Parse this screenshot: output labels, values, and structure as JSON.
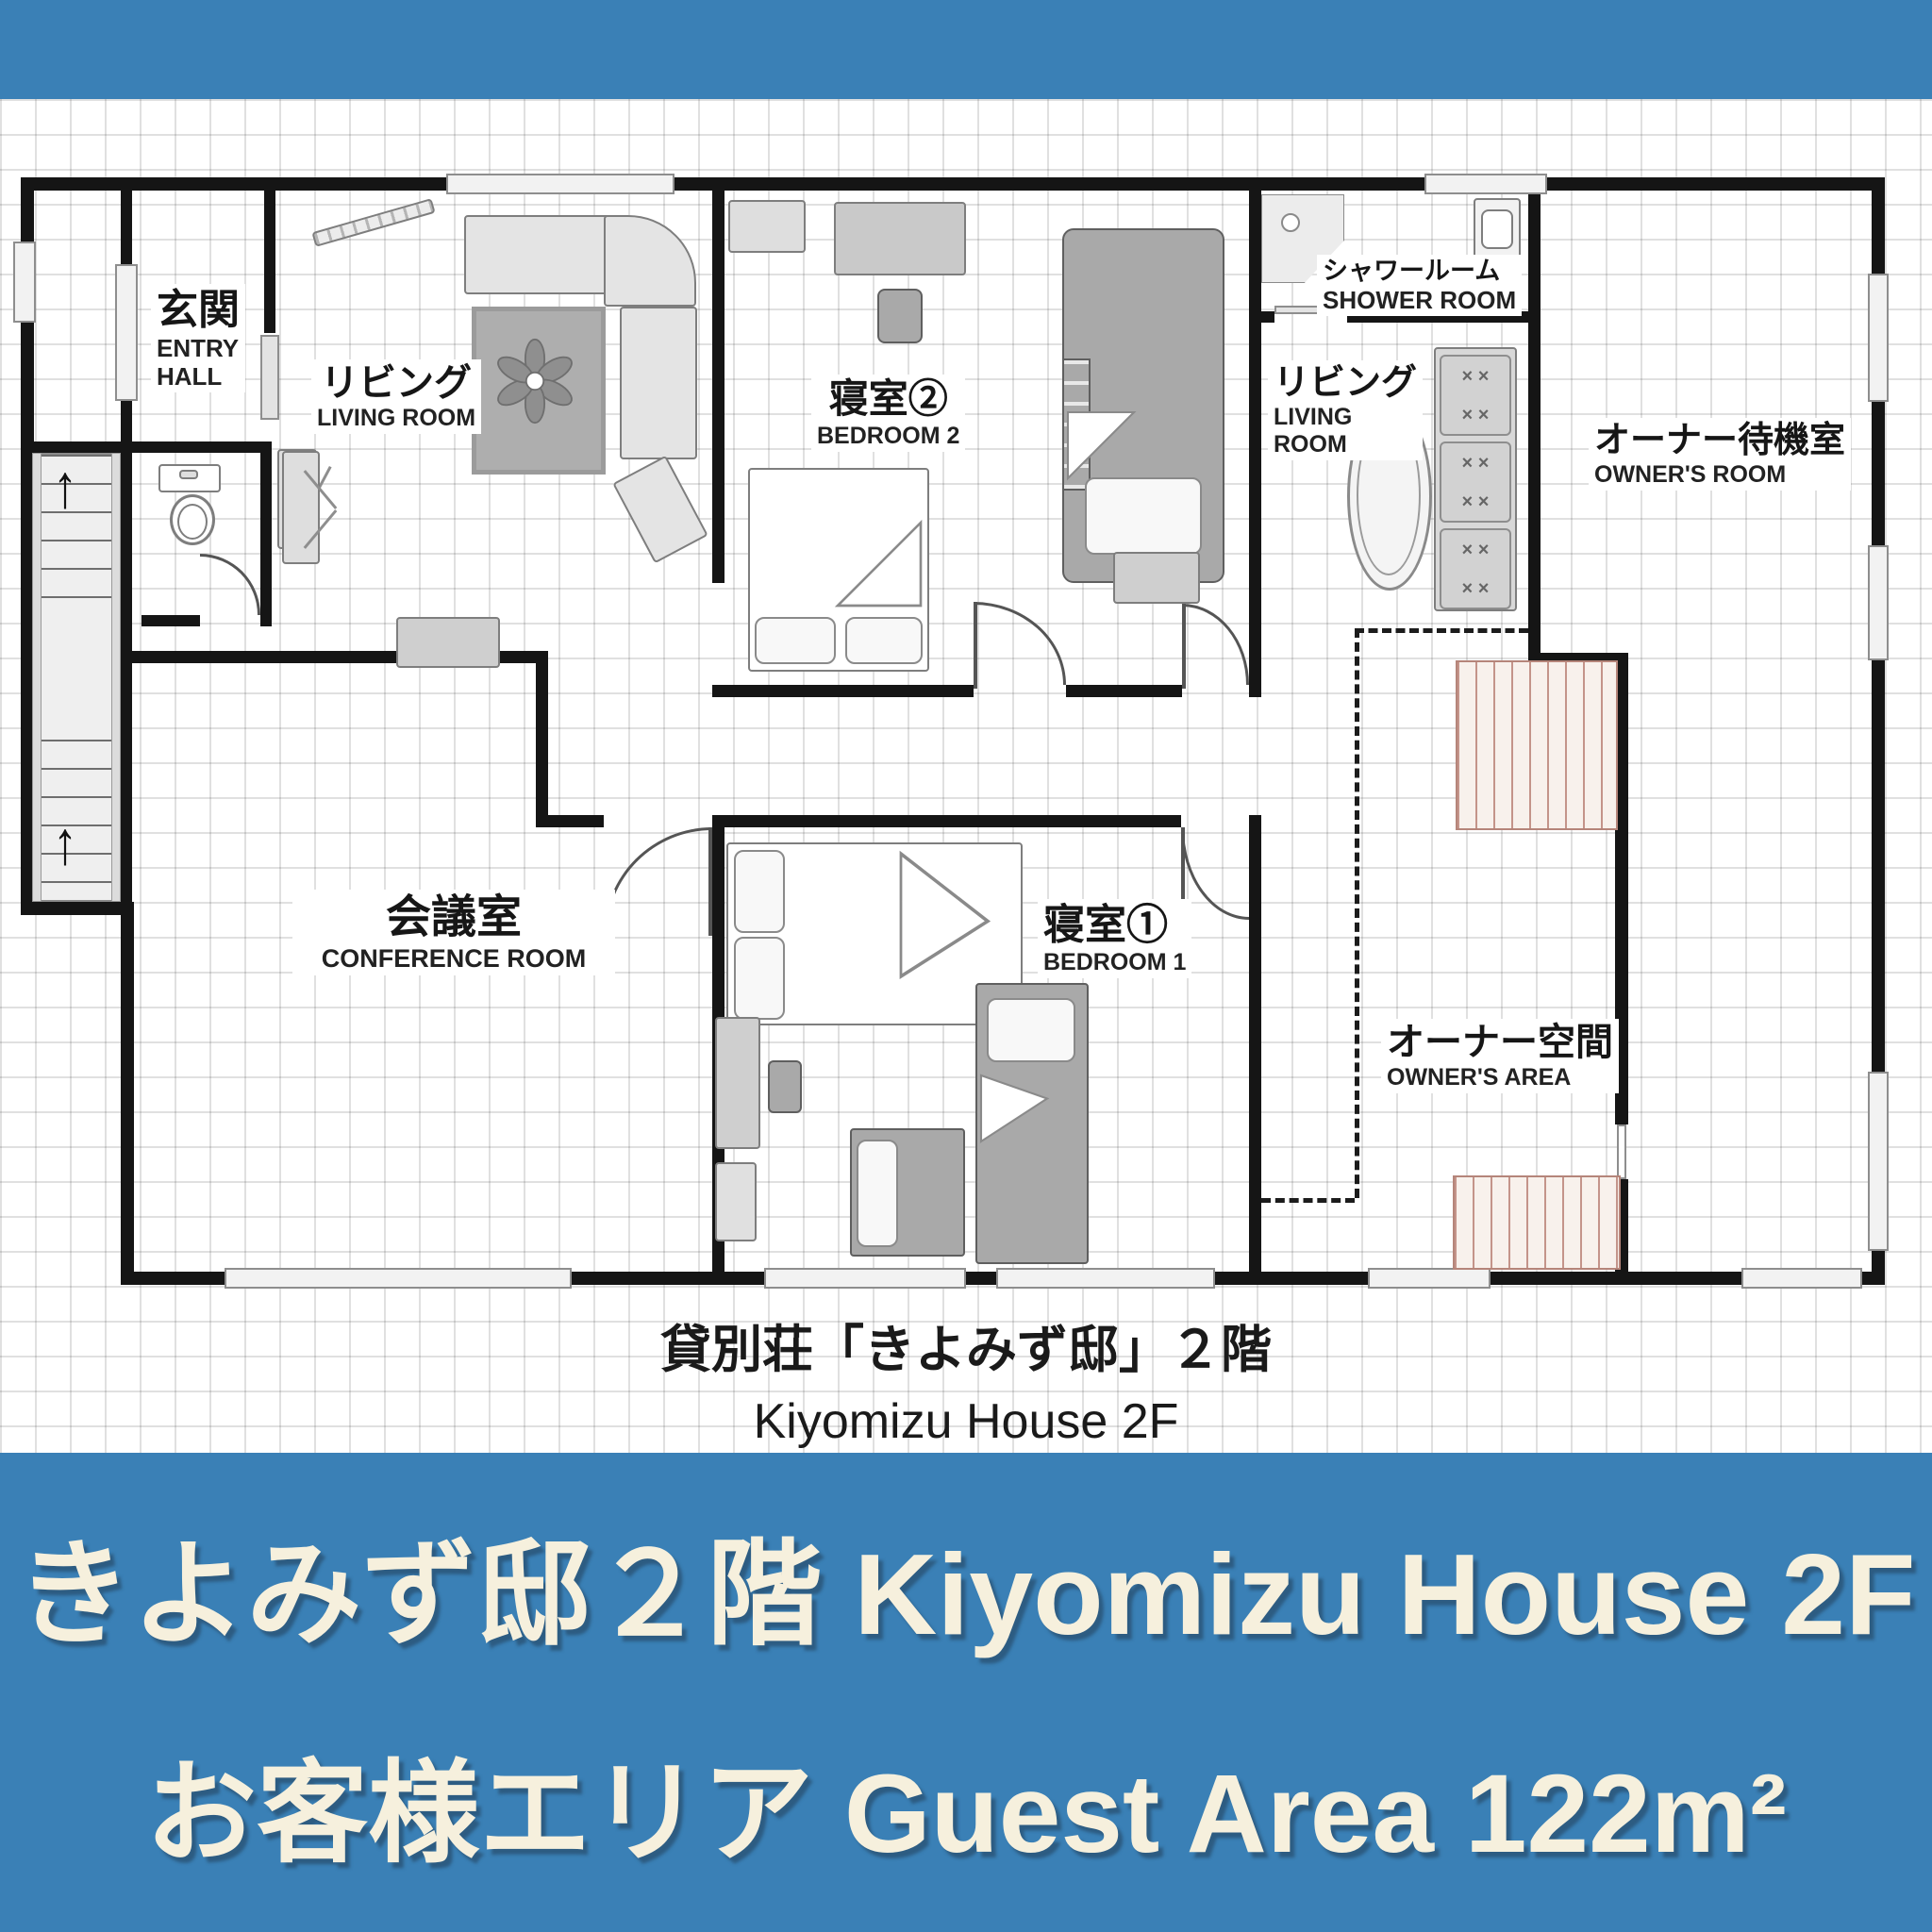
{
  "colors": {
    "accent_blue": "#3a80b6",
    "banner_text": "#f6f0dd",
    "wall": "#151515",
    "stair_red": "#c4948a"
  },
  "floorplan": {
    "rooms": {
      "entry": {
        "ja": "玄関",
        "en1": "ENTRY",
        "en2": "HALL"
      },
      "living_left": {
        "ja": "リビング",
        "en": "LIVING ROOM"
      },
      "bedroom2": {
        "ja": "寝室②",
        "en": "BEDROOM 2"
      },
      "shower": {
        "ja": "シャワールーム",
        "en": "SHOWER ROOM"
      },
      "living_right": {
        "ja": "リビング",
        "en1": "LIVING",
        "en2": "ROOM"
      },
      "owners_room": {
        "ja": "オーナー待機室",
        "en": "OWNER'S ROOM"
      },
      "conference": {
        "ja": "会議室",
        "en": "CONFERENCE ROOM"
      },
      "bedroom1": {
        "ja": "寝室①",
        "en": "BEDROOM 1"
      },
      "owners_area": {
        "ja": "オーナー空間",
        "en": "OWNER'S AREA"
      }
    },
    "caption": {
      "line1_ja": "貸別荘「きよみず邸」２階",
      "line2_en": "Kiyomizu House 2F"
    }
  },
  "bottom_banner": {
    "line1": "きよみず邸２階 Kiyomizu House 2F",
    "line2": "お客様エリア Guest Area 122m²"
  },
  "icons": {
    "up_arrow": "↑",
    "cushion_pattern": "× ×"
  }
}
